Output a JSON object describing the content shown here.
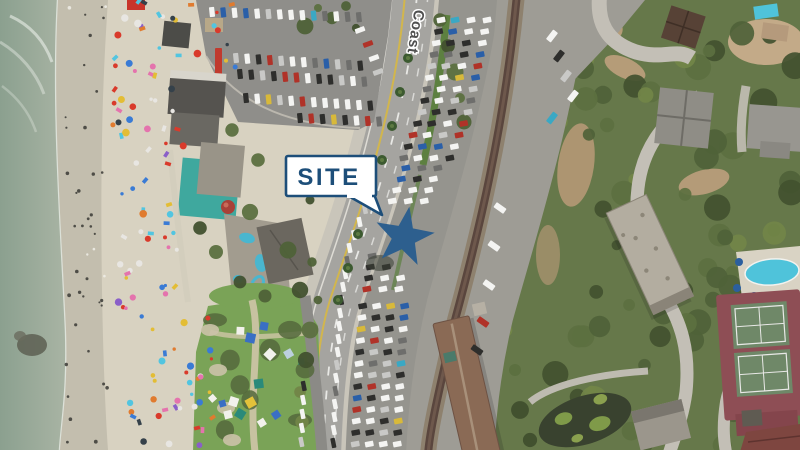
{
  "page": {
    "type": "aerial-site-exhibit",
    "description": "Oblique aerial photo of a coastal site with beach, Coast Highway, parking lots, railroad corridor and hillside buildings"
  },
  "annotations": {
    "site_callout": {
      "label": "SITE",
      "text_color": "#1d4e79",
      "box_fill": "#ffffff",
      "border_color": "#1d4e79",
      "marker": "star",
      "marker_color": "#2d5f8e"
    },
    "road_label": {
      "text": "Coast",
      "color": "#4f4f4f",
      "halo": "#ffffff"
    }
  },
  "map_features": {
    "names": [
      "ocean",
      "surf",
      "beach",
      "beach-crowd",
      "grass-park",
      "tents",
      "beachfront-buildings",
      "north-parking-lot",
      "coast-highway",
      "median-parking-lot",
      "railroad-corridor",
      "train-station",
      "hillside-vegetation",
      "access-roads",
      "pond",
      "industrial-building",
      "residential-buildings",
      "swimming-pool",
      "tennis-courts"
    ],
    "colors": {
      "ocean": "#97a898",
      "wet_sand": "#c3beae",
      "sand": "#d8d2c1",
      "grass": "#7aa357",
      "asphalt": "#a5a4a0",
      "lot_asphalt": "#95948e",
      "gravel": "#9e9c95",
      "rail": "#5a463e",
      "vegetation": "#66784a",
      "station_roof": "#8a6a55",
      "tennis_surround": "#8e4e55",
      "tennis_court": "#6f8868",
      "pool_water": "#4fc3da",
      "road_yellow_line": "#d2b64c"
    }
  },
  "decor": {
    "counts": {
      "beach_umbrellas": 118,
      "shore_people": 42,
      "east_trees": 78,
      "tents": 15
    },
    "umbrella_palette": [
      [
        "#e8e6e2",
        0.18
      ],
      [
        "#3a7bd5",
        0.14
      ],
      [
        "#d93a2b",
        0.12
      ],
      [
        "#52c5e0",
        0.1
      ],
      [
        "#e473ad",
        0.1
      ],
      [
        "#e3bd35",
        0.08
      ],
      [
        "#e07b2f",
        0.08
      ],
      [
        "#8a5fc8",
        0.05
      ],
      [
        "#35414a",
        0.15
      ],
      [
        "#7fd0b0",
        0.1
      ]
    ],
    "car_palette": [
      [
        "#f4f4f2",
        0.42
      ],
      [
        "#c9c9c7",
        0.15
      ],
      [
        "#2e2e2c",
        0.18
      ],
      [
        "#6e6e6c",
        0.08
      ],
      [
        "#b03228",
        0.07
      ],
      [
        "#2a5fa8",
        0.06
      ],
      [
        "#3aa8c4",
        0.02
      ],
      [
        "#d8b93a",
        0.02
      ]
    ],
    "tent_palette": [
      [
        "#f2f1ec",
        0.3
      ],
      [
        "#3a6fc4",
        0.24
      ],
      [
        "#2a8a7a",
        0.16
      ],
      [
        "#e3c23a",
        0.1
      ],
      [
        "#bcd0de",
        0.2
      ]
    ],
    "tree_palette": [
      [
        "#42512f",
        0.3
      ],
      [
        "#4f6238",
        0.3
      ],
      [
        "#5c7040",
        0.25
      ],
      [
        "#728548",
        0.15
      ]
    ]
  }
}
